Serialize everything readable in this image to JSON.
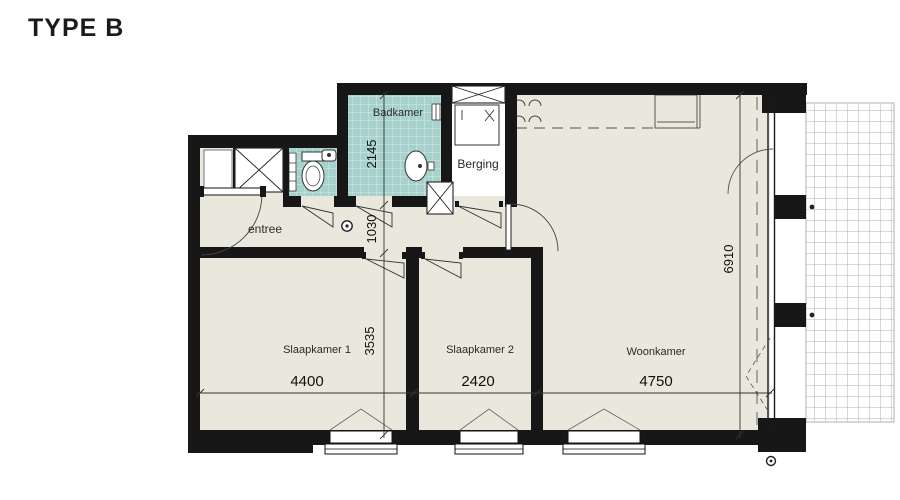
{
  "title": "TYPE B",
  "plan": {
    "rooms": {
      "badkamer": "Badkamer",
      "berging": "Berging",
      "entree": "entree",
      "slaapkamer1": "Slaapkamer 1",
      "slaapkamer2": "Slaapkamer 2",
      "woonkamer": "Woonkamer"
    },
    "dimensions": {
      "badkamer_depth": "2145",
      "hal_depth": "1030",
      "slaapkamer_depth": "3535",
      "slaapkamer1_width": "4400",
      "slaapkamer2_width": "2420",
      "woonkamer_width": "4750",
      "woonkamer_depth": "6910"
    },
    "colors": {
      "wall": "#171717",
      "floor": "#eae7dc",
      "tile": "#a7d1cc",
      "balcony_grid": "#b0b0b0"
    }
  }
}
